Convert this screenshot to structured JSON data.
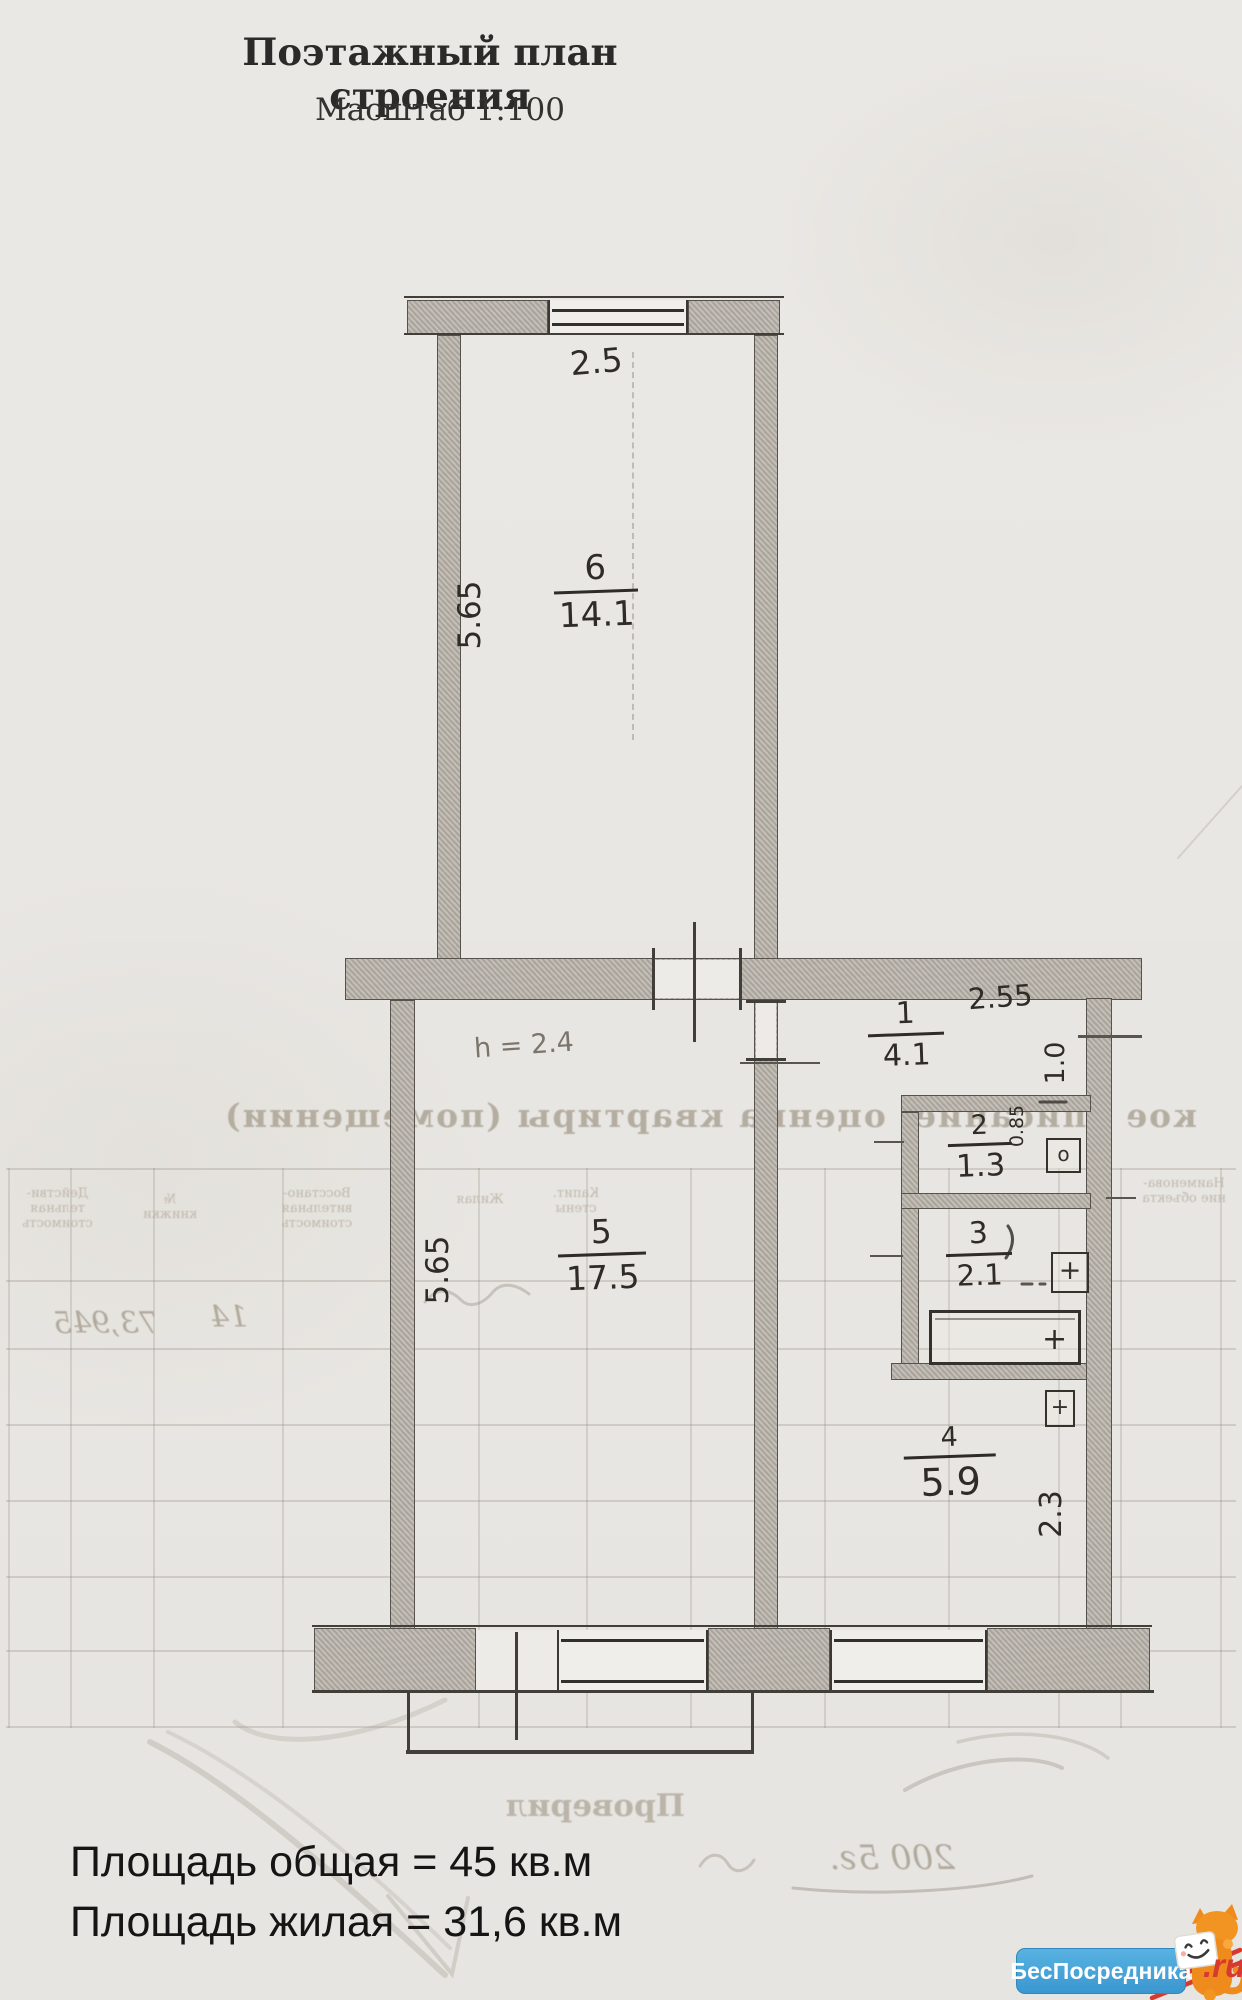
{
  "document": {
    "title": "Поэтажный план строения",
    "scale": "Масштаб 1:100"
  },
  "plan": {
    "rooms": {
      "r6": {
        "number": "6",
        "area": "14.1"
      },
      "r5": {
        "number": "5",
        "area": "17.5"
      },
      "r1": {
        "number": "1",
        "area": "4.1"
      },
      "r2": {
        "number": "2",
        "area": "1.3"
      },
      "r3": {
        "number": "3",
        "area": "2.1"
      },
      "r4": {
        "number": "4",
        "area": "5.9"
      }
    },
    "dimensions": {
      "room6_width": "2.5",
      "room6_depth": "5.65",
      "room5_depth": "5.65",
      "hall_width": "2.55",
      "hall_depth": "1.0",
      "wc_width": "0.85",
      "kitchen_depth": "2.3",
      "ceiling_height": "h = 2.4"
    },
    "fixtures": {
      "sink": "o",
      "toilet_cross": "+",
      "bath_cross": "+",
      "vent_cross": "+"
    }
  },
  "bleedthrough": {
    "section_title": "кое описание, оценка квартиры (помещении)",
    "table_headers": [
      [
        "Действи-",
        "тельная",
        "стоимость"
      ],
      [
        "№",
        "книжки"
      ],
      [
        "Восстано-",
        "вительная",
        "стоимость"
      ],
      [
        "Жилая"
      ],
      [
        "Капит.",
        "стены"
      ],
      [
        "Наименова-",
        "ние объекта"
      ]
    ],
    "row_values": [
      "73,945",
      "14"
    ],
    "verified_label": "Проверил",
    "handwritten_note": "200 5г."
  },
  "summary": {
    "total_area": "Площадь общая = 45 кв.м",
    "living_area": "Площадь жилая = 31,6 кв.м"
  },
  "watermark": {
    "brand": "БесПосредника",
    "suffix": ".ru"
  }
}
